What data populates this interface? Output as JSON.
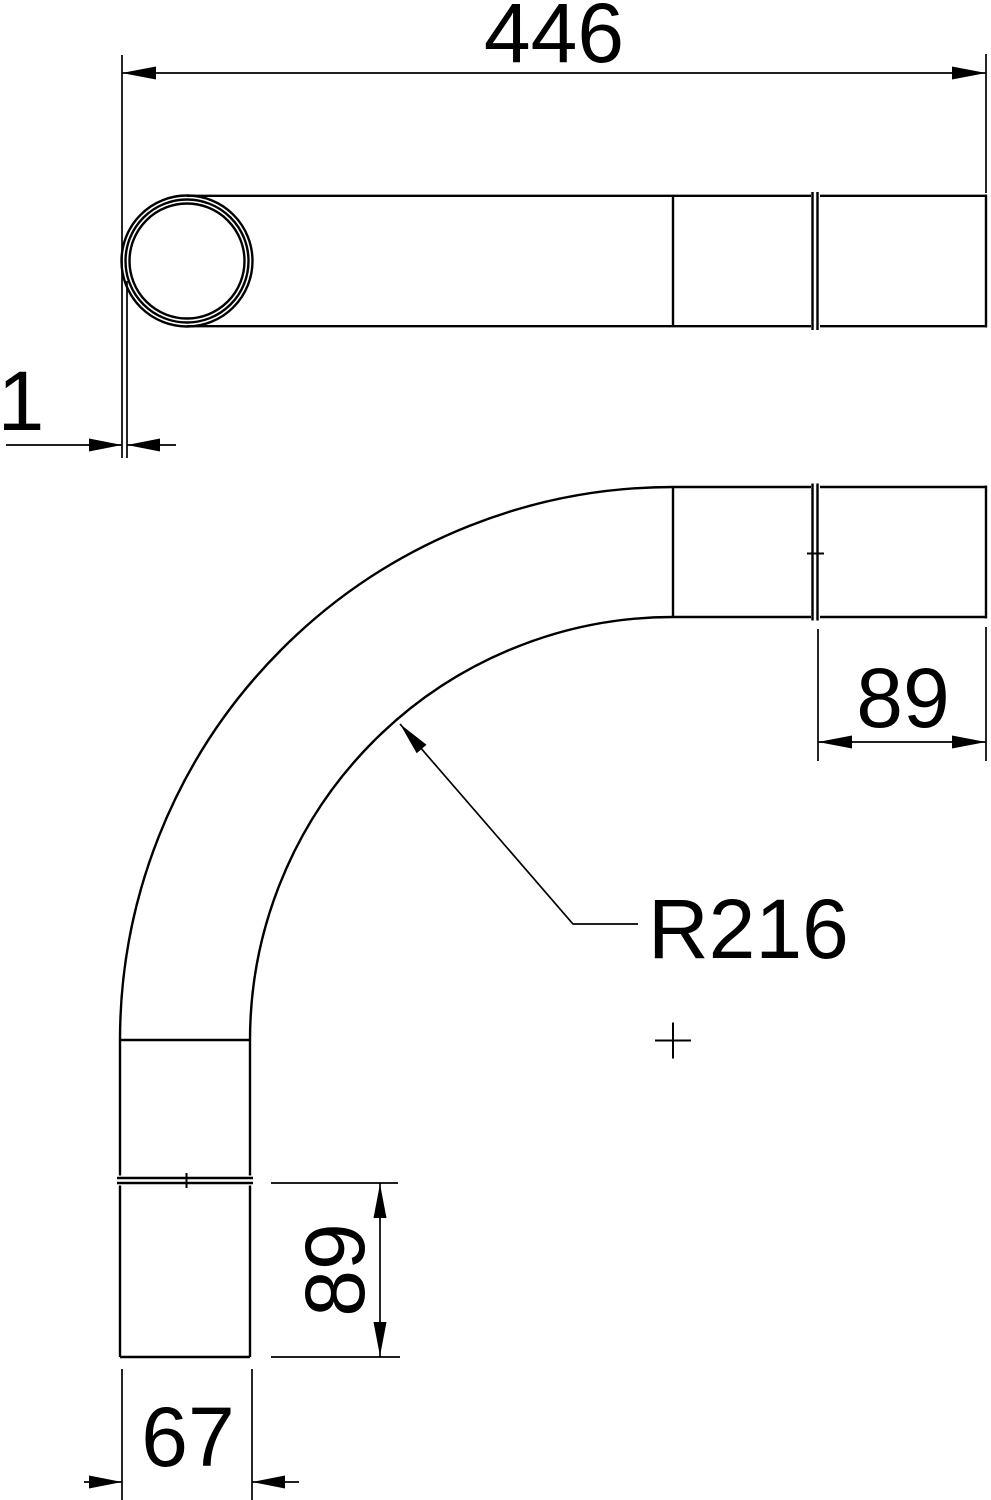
{
  "drawing": {
    "background_color": "#ffffff",
    "line_color": "#000000",
    "dimensions": {
      "overall_length": {
        "label": "446"
      },
      "end_offset": {
        "label": "1"
      },
      "socket_right": {
        "label": "89"
      },
      "bend_radius": {
        "label": "R216"
      },
      "socket_bottom": {
        "label": "89"
      },
      "width": {
        "label": "67"
      }
    }
  }
}
